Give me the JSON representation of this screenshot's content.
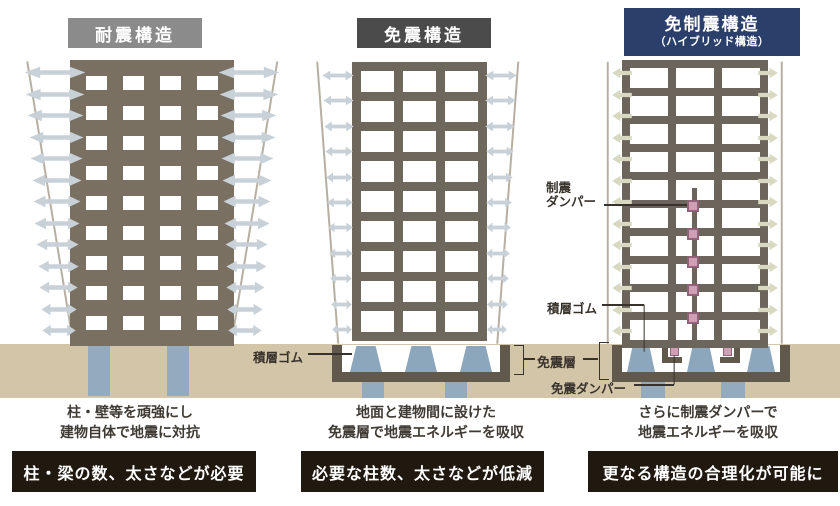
{
  "panels": [
    {
      "header": {
        "title": "耐震構造"
      },
      "caption": [
        "柱・壁等を頑強にし",
        "建物自体で地震に対抗"
      ],
      "verdict": "柱・梁の数、太さなどが必要"
    },
    {
      "header": {
        "title": "免震構造"
      },
      "caption": [
        "地面と建物間に設けた",
        "免震層で地震エネルギーを吸収"
      ],
      "verdict": "必要な柱数、太さなどが低減"
    },
    {
      "header": {
        "title": "免制震構造",
        "subtitle": "（ハイブリッド構造）"
      },
      "caption": [
        "さらに制震ダンパーで",
        "地震エネルギーを吸収"
      ],
      "verdict": "更なる構造の合理化が可能に"
    }
  ],
  "annotations": {
    "seishin_damper_line1": "制震",
    "seishin_damper_line2": "ダンパー",
    "sekisou_gomu": "積層ゴム",
    "menshin_sou": "免震層",
    "menshin_damper": "免震ダンパー"
  },
  "colors": {
    "header_taishin_bg": "#8b8b8b",
    "header_menshin_bg": "#4b4b4b",
    "header_hybrid_bg": "#2b3f6b",
    "verdict_bg": "#201910",
    "ground": "#d3c5a7",
    "frame_b1": "#7a7062",
    "frame_b2": "#6e675b",
    "frame_b3": "#6b655b",
    "foundation": "#615a4c",
    "arrow_blue_gray": "#c8d1d7",
    "arrow_olive": "#d9d9c2",
    "pile_blue": "#94abbe",
    "bearing_blue": "#8ca7bc",
    "damper_pink": "#cf9fb5",
    "damper_pink_border": "#936179",
    "annotation_line": "#38322c",
    "sway_line": "#b7afa2"
  },
  "figures": {
    "b1": {
      "floors": 9,
      "bays": 4,
      "arrows_per_side": 13,
      "arrow_style": "double"
    },
    "b2": {
      "floors": 9,
      "bays": 3,
      "arrows_per_side": 11,
      "arrow_style": "double"
    },
    "b3": {
      "floors": 10,
      "bays": 3,
      "arrows_per_side": 13,
      "arrow_style": "outward",
      "story_dampers": 5,
      "base_bearings": 3,
      "base_dampers": 2
    },
    "b2_base_bearings": 3,
    "b1_piles": 2,
    "b2_piles": 2,
    "b3_piles": 2
  }
}
